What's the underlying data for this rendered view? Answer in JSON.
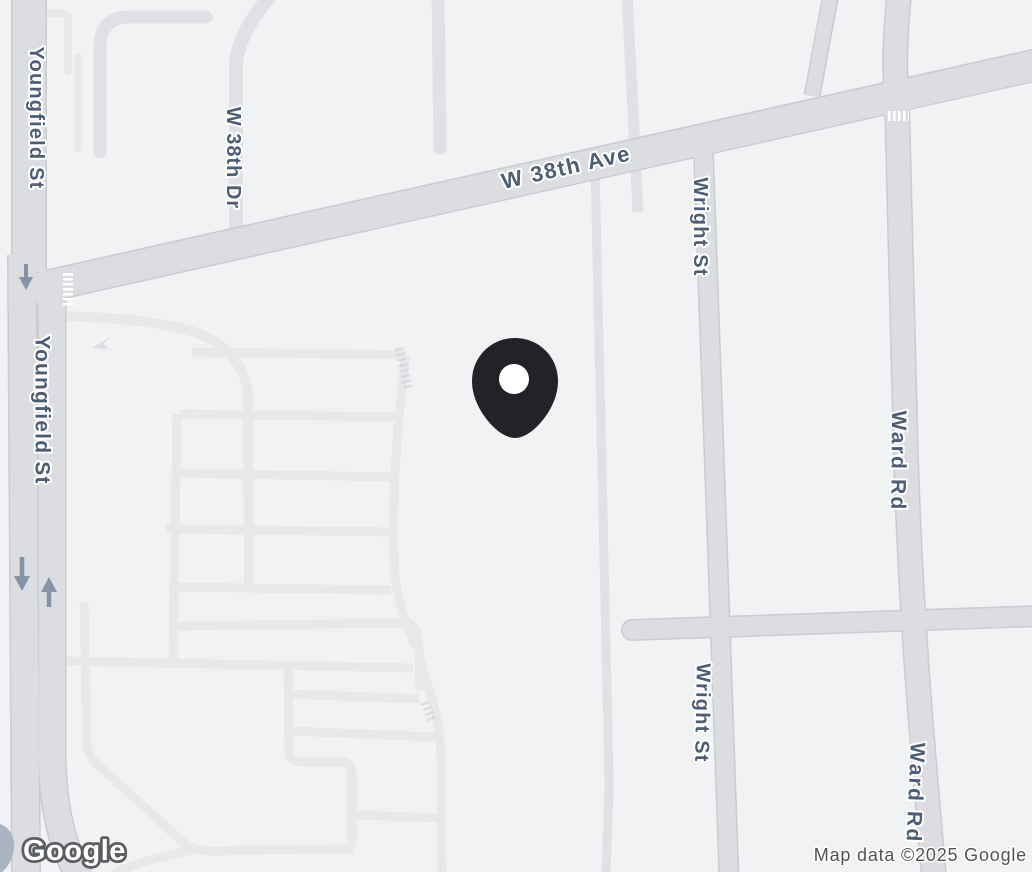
{
  "map": {
    "provider_watermark": "Google",
    "attribution": "Map data ©2025 Google",
    "labels": {
      "youngfield_st_1": "Youngfield St",
      "youngfield_st_2": "Youngfield St",
      "w_38th_dr": "W 38th Dr",
      "w_38th_ave": "W 38th Ave",
      "wright_st_1": "Wright St",
      "wright_st_2": "Wright St",
      "ward_rd_1": "Ward Rd",
      "ward_rd_2": "Ward Rd"
    },
    "marker": {
      "name": "dropped-pin",
      "approx_x": 515,
      "approx_y": 438
    }
  },
  "colors": {
    "bg_color": "#f1f2f4",
    "road_major": "#dbdde0",
    "road_casing": "#c9ccd1",
    "road_minor": "#dfe1e4",
    "road_lane": "#e7e8ea",
    "label_color": "#4c5e76",
    "arrow_color": "#8593a6",
    "pin_color": "#222326",
    "water_color": "#aab4c1",
    "logo_outline": "#5b5e61",
    "attribution_color": "#4f5357"
  }
}
